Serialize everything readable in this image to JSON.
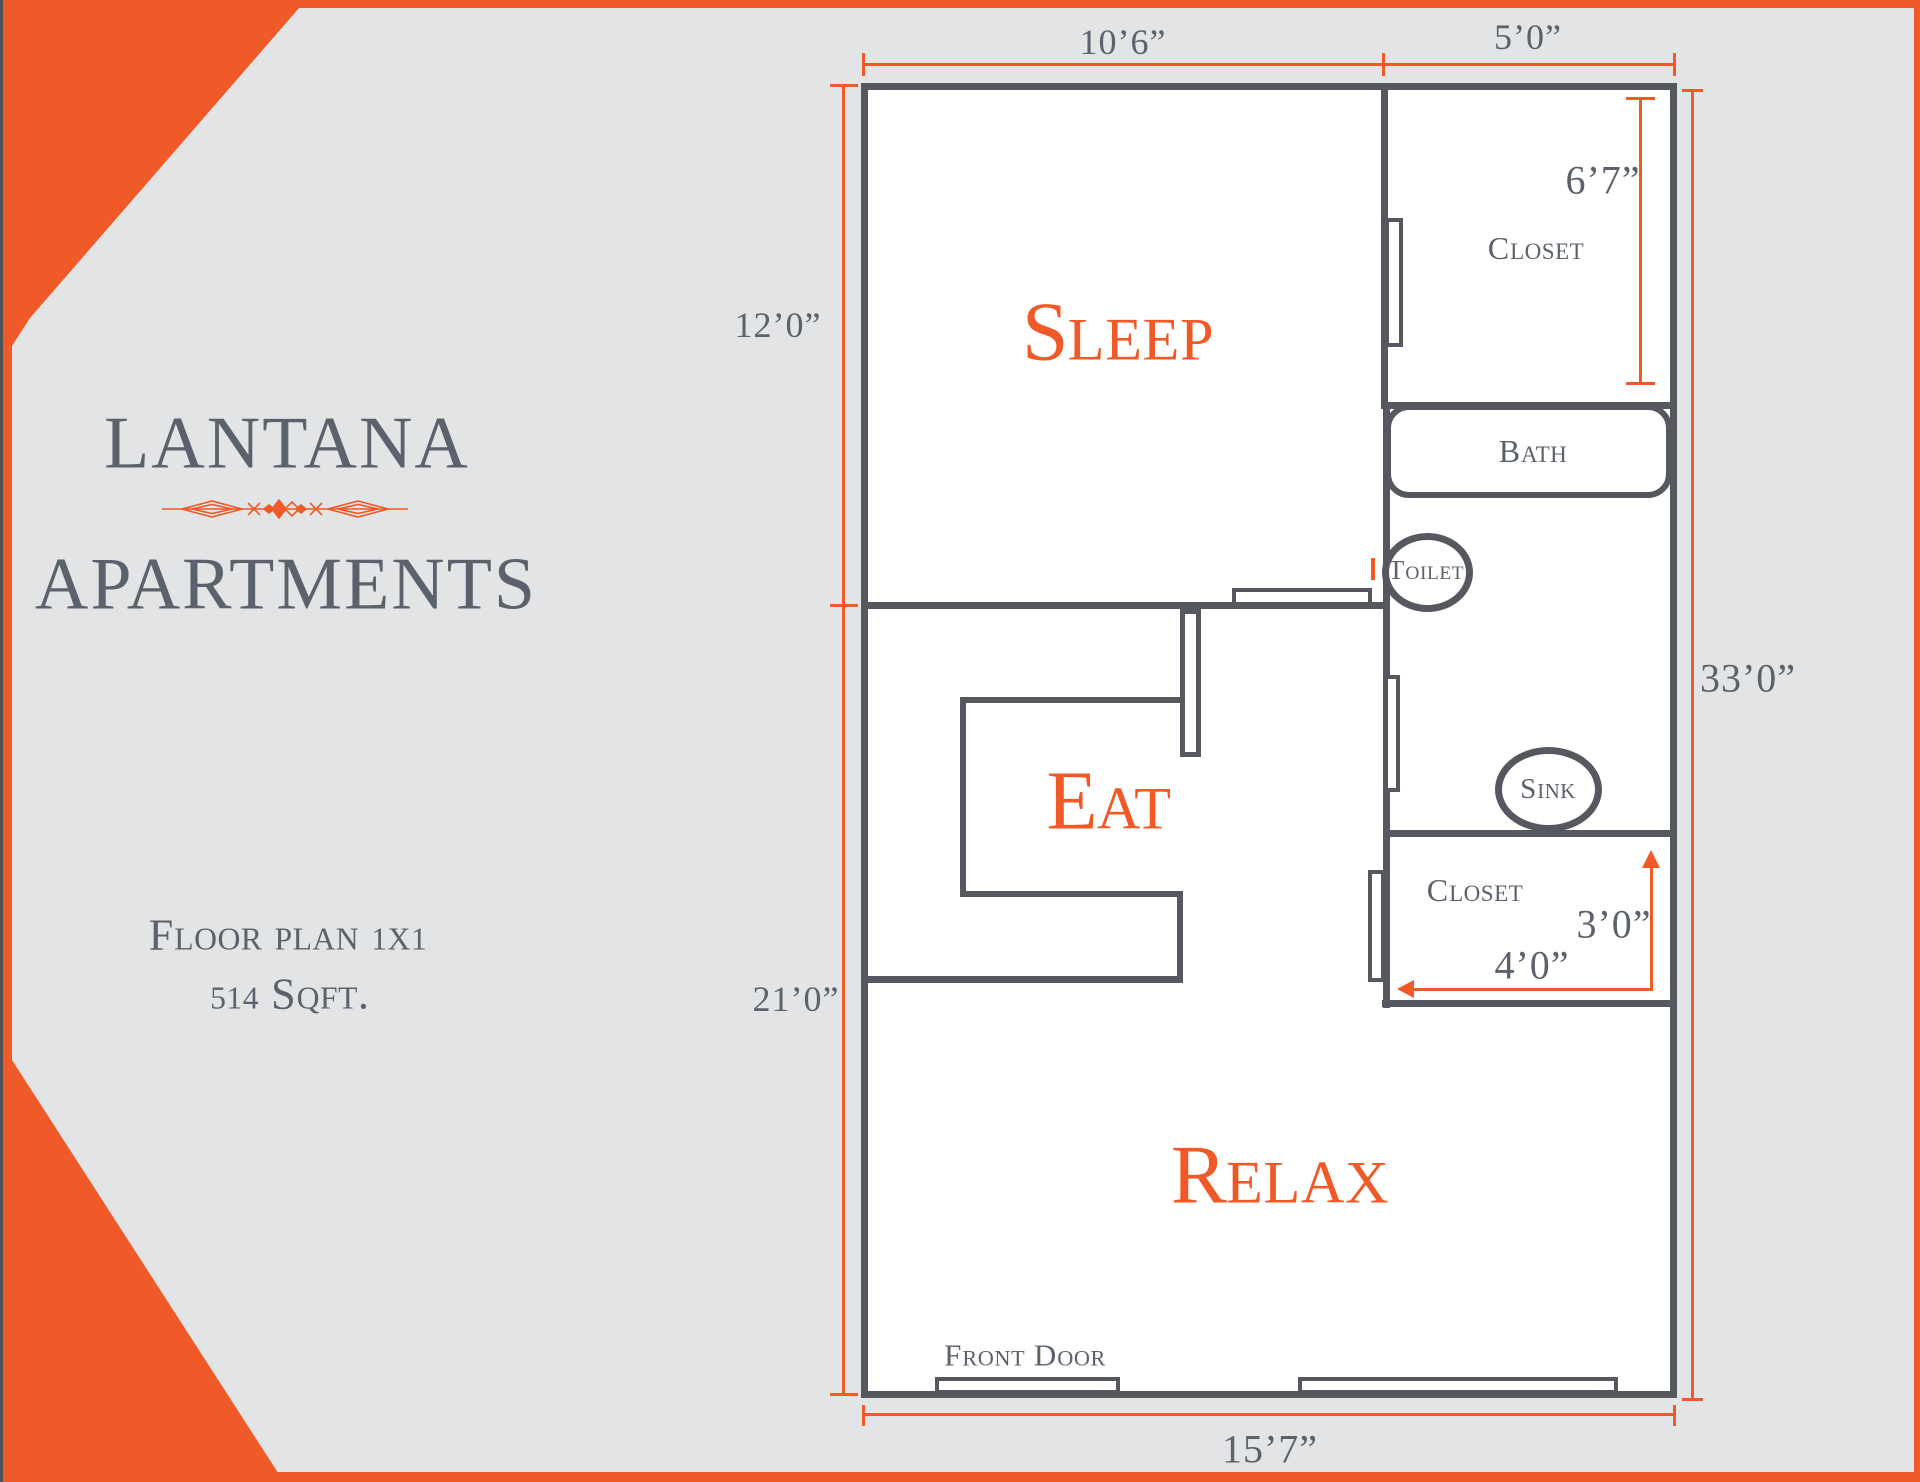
{
  "brand": {
    "name_line1": "LANTANA",
    "name_line2": "APARTMENTS",
    "plan_label": "Floor plan 1x1",
    "area_label": "514 Sqft."
  },
  "rooms": {
    "sleep": "Sleep",
    "eat": "Eat",
    "relax": "Relax"
  },
  "fixtures": {
    "closet_top": "Closet",
    "bath": "Bath",
    "toilet": "Toilet",
    "sink": "Sink",
    "closet_bottom": "Closet",
    "front_door": "Front Door"
  },
  "dimensions": {
    "top_left_width": "10’6”",
    "top_right_width": "5’0”",
    "left_upper_height": "12’0”",
    "left_lower_height": "21’0”",
    "right_full_height": "33’0”",
    "closet_height": "6’7”",
    "lower_closet_height": "3’0”",
    "lower_closet_width": "4’0”",
    "bottom_width": "15’7”"
  },
  "colors": {
    "accent": "#ef5a28",
    "wall": "#55585e",
    "text": "#5b626b",
    "bg": "#e3e4e6"
  }
}
